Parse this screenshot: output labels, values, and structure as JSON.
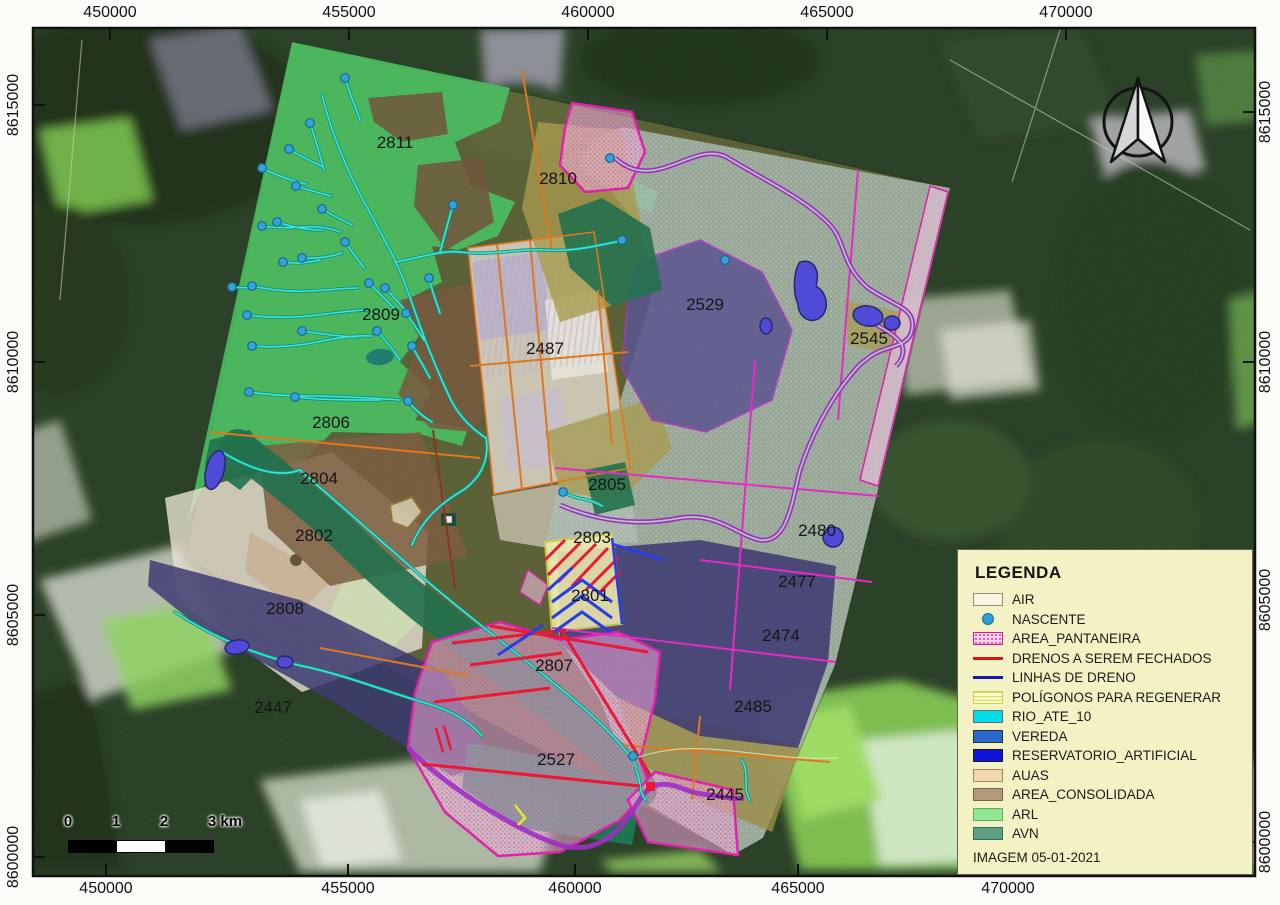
{
  "grid": {
    "top": [
      {
        "label": "450000",
        "x": 110
      },
      {
        "label": "455000",
        "x": 349
      },
      {
        "label": "460000",
        "x": 588
      },
      {
        "label": "465000",
        "x": 827
      },
      {
        "label": "470000",
        "x": 1066
      }
    ],
    "bottom": [
      {
        "label": "450000",
        "x": 106
      },
      {
        "label": "455000",
        "x": 348
      },
      {
        "label": "460000",
        "x": 575
      },
      {
        "label": "465000",
        "x": 798
      },
      {
        "label": "470000",
        "x": 1008
      }
    ],
    "left": [
      {
        "label": "8615000",
        "y": 105
      },
      {
        "label": "8610000",
        "y": 362
      },
      {
        "label": "8605000",
        "y": 615
      },
      {
        "label": "8600000",
        "y": 857
      }
    ],
    "right": [
      {
        "label": "8615000",
        "y": 112
      },
      {
        "label": "8610000",
        "y": 362
      },
      {
        "label": "8605000",
        "y": 600
      },
      {
        "label": "8600000",
        "y": 842
      }
    ]
  },
  "parcels": [
    {
      "id": "2811",
      "x": 395,
      "y": 148
    },
    {
      "id": "2810",
      "x": 558,
      "y": 184
    },
    {
      "id": "2809",
      "x": 381,
      "y": 320
    },
    {
      "id": "2487",
      "x": 545,
      "y": 354
    },
    {
      "id": "2529",
      "x": 705,
      "y": 310
    },
    {
      "id": "2545",
      "x": 869,
      "y": 344
    },
    {
      "id": "2806",
      "x": 331,
      "y": 428
    },
    {
      "id": "2804",
      "x": 319,
      "y": 484
    },
    {
      "id": "2805",
      "x": 607,
      "y": 490
    },
    {
      "id": "2802",
      "x": 314,
      "y": 541
    },
    {
      "id": "2803",
      "x": 592,
      "y": 543
    },
    {
      "id": "2480",
      "x": 817,
      "y": 536
    },
    {
      "id": "2477",
      "x": 797,
      "y": 587
    },
    {
      "id": "2801",
      "x": 590,
      "y": 601
    },
    {
      "id": "2808",
      "x": 285,
      "y": 614
    },
    {
      "id": "2474",
      "x": 781,
      "y": 641
    },
    {
      "id": "2807",
      "x": 554,
      "y": 671
    },
    {
      "id": "2485",
      "x": 753,
      "y": 712
    },
    {
      "id": "2447",
      "x": 273,
      "y": 713
    },
    {
      "id": "2527",
      "x": 556,
      "y": 765
    },
    {
      "id": "2445",
      "x": 725,
      "y": 800
    }
  ],
  "springs": [
    [
      345,
      78
    ],
    [
      310,
      123
    ],
    [
      289,
      149
    ],
    [
      262,
      168
    ],
    [
      296,
      186
    ],
    [
      277,
      222
    ],
    [
      322,
      209
    ],
    [
      262,
      226
    ],
    [
      302,
      258
    ],
    [
      283,
      262
    ],
    [
      232,
      287
    ],
    [
      252,
      286
    ],
    [
      345,
      242
    ],
    [
      369,
      283
    ],
    [
      385,
      288
    ],
    [
      429,
      278
    ],
    [
      406,
      313
    ],
    [
      247,
      315
    ],
    [
      252,
      346
    ],
    [
      302,
      331
    ],
    [
      377,
      331
    ],
    [
      412,
      346
    ],
    [
      249,
      392
    ],
    [
      295,
      397
    ],
    [
      408,
      401
    ],
    [
      453,
      205
    ],
    [
      622,
      240
    ],
    [
      610,
      158
    ],
    [
      725,
      260
    ],
    [
      563,
      492
    ],
    [
      633,
      756
    ]
  ],
  "legend": {
    "title": "LEGENDA",
    "footer": "IMAGEM 05-01-2021",
    "items": [
      {
        "label": "AIR",
        "type": "rect",
        "fill": "#f8f4e2",
        "border": "#8f8f7c"
      },
      {
        "label": "NASCENTE",
        "type": "point",
        "fill": "#2e9fd4",
        "border": "#1a6a9a"
      },
      {
        "label": "AREA_PANTANEIRA",
        "type": "hatch",
        "fill": "#f6d4ec",
        "dot": "#d8359e",
        "border": "#d81898"
      },
      {
        "label": "DRENOS A SEREM FECHADOS",
        "type": "line",
        "fill": "#dc1414"
      },
      {
        "label": "LINHAS DE DRENO",
        "type": "line",
        "fill": "#1616a8"
      },
      {
        "label": "POLÍGONOS PARA REGENERAR",
        "type": "ylines",
        "fill": "#fbf9cf",
        "line": "#e0dc52",
        "border": "#cfcf4e"
      },
      {
        "label": "RIO_ATE_10",
        "type": "rect",
        "fill": "#00dce8",
        "border": "#6a6a6a"
      },
      {
        "label": "VEREDA",
        "type": "rect",
        "fill": "#2968cc",
        "border": "#2a2a2a"
      },
      {
        "label": "RESERVATORIO_ARTIFICIAL",
        "type": "rect",
        "fill": "#1212dc",
        "border": "#1a1a1a"
      },
      {
        "label": "AUAS",
        "type": "rect",
        "fill": "#f0d8a8",
        "border": "#9a8a68"
      },
      {
        "label": "AREA_CONSOLIDADA",
        "type": "rect",
        "fill": "#b49a7c",
        "border": "#746250"
      },
      {
        "label": "ARL",
        "type": "rect",
        "fill": "#92e892",
        "border": "#66aa66"
      },
      {
        "label": "AVN",
        "type": "rect",
        "fill": "#5ea085",
        "border": "#3a6a55"
      }
    ]
  },
  "scalebar": {
    "ticks": [
      {
        "label": "0",
        "x": 68
      },
      {
        "label": "1",
        "x": 116
      },
      {
        "label": "2",
        "x": 164
      },
      {
        "label": "3 km",
        "x": 225
      }
    ]
  },
  "colors": {
    "legend_bg": "#f2f2c5",
    "frame": "#111111",
    "label_text": "#151515"
  }
}
